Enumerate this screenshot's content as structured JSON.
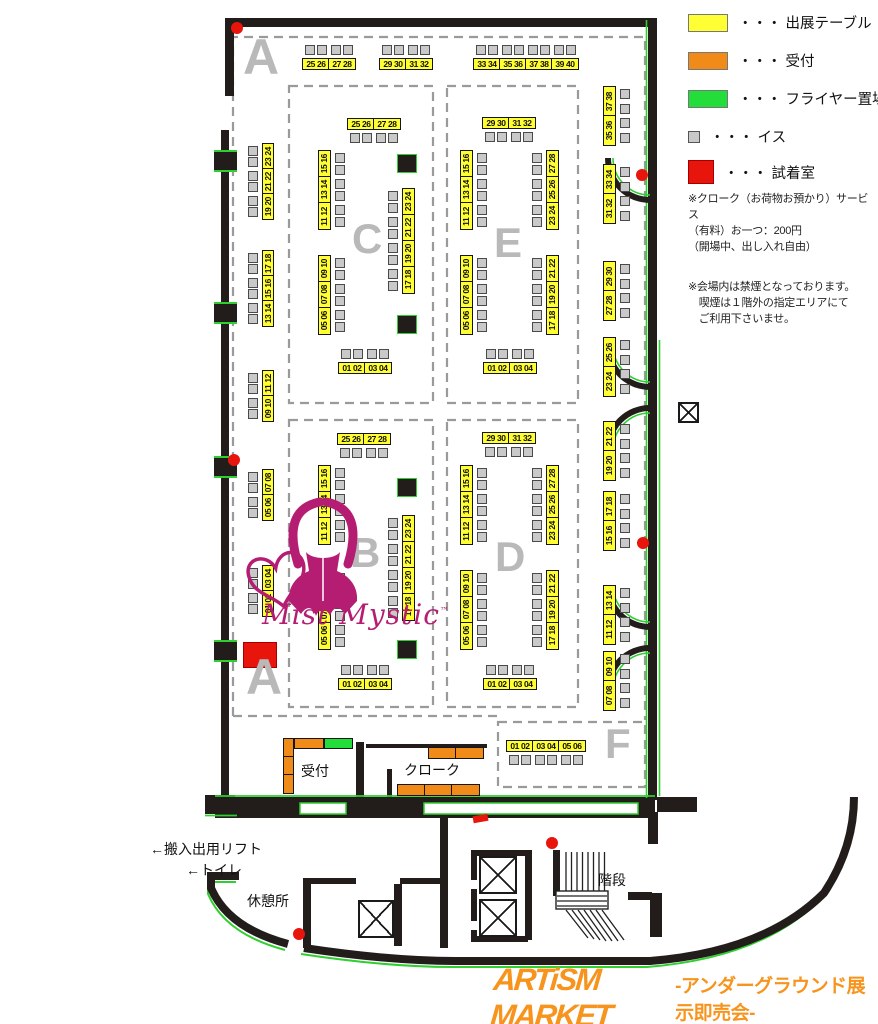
{
  "legend": {
    "items": [
      {
        "key": "exhibit-table",
        "color": "#ffff33",
        "label": "・・・ 出展テーブル"
      },
      {
        "key": "reception",
        "color": "#f08a19",
        "label": "・・・ 受付"
      },
      {
        "key": "flyer-area",
        "color": "#22dd3a",
        "label": "・・・ フライヤー置場"
      },
      {
        "key": "chair",
        "color": "#c9c9c9",
        "label": "・・・ イス"
      },
      {
        "key": "fitting-room",
        "color": "#e8150d",
        "label": "・・・ 試着室"
      }
    ]
  },
  "notes": [
    "※クローク（お荷物お預かり）サービス\n（有料）お一つ：200円\n（開場中、出し入れ自由）",
    "※会場内は禁煙となっております。\n　喫煙は１階外の指定エリアにて\n　ご利用下さいませ。"
  ],
  "labels": {
    "reception": "受付",
    "cloak": "クローク",
    "stairs": "階段",
    "rest_area": "休憩所",
    "toilet": "←トイレ",
    "lift": "←搬入出用リフト"
  },
  "logo": {
    "brand": "ARTiSM MARKET",
    "tagline": "-アンダーグラウンド展示即売会-",
    "mist": "Mist Mystic",
    "tm": "™"
  },
  "colors": {
    "table": "#ffff33",
    "reception": "#f08a19",
    "flyer": "#22dd3a",
    "chair": "#c9c9c9",
    "fitting": "#e8150d",
    "wall": "#221d1a",
    "accent_green": "#2fcf2f",
    "letter": "#b9b9b9",
    "brand": "#f7941d",
    "mist": "#b51d73"
  },
  "sections": [
    {
      "label": "A",
      "x": 243,
      "y": 36,
      "size": 50
    },
    {
      "label": "C",
      "x": 352,
      "y": 221,
      "size": 42
    },
    {
      "label": "E",
      "x": 494,
      "y": 225,
      "size": 42
    },
    {
      "label": "B",
      "x": 350,
      "y": 535,
      "size": 42
    },
    {
      "label": "D",
      "x": 495,
      "y": 539,
      "size": 42
    },
    {
      "label": "A",
      "x": 246,
      "y": 656,
      "size": 50
    },
    {
      "label": "F",
      "x": 605,
      "y": 726,
      "size": 42
    }
  ],
  "plan": {
    "table_groups": [
      {
        "sec": "A",
        "o": "h",
        "x": 302,
        "y": 58,
        "sw": 28,
        "sh": 12,
        "labels": [
          "25 26",
          "27 28"
        ],
        "chairs": "top"
      },
      {
        "sec": "A",
        "o": "h",
        "x": 379,
        "y": 58,
        "sw": 28,
        "sh": 12,
        "labels": [
          "29 30",
          "31 32"
        ],
        "chairs": "top"
      },
      {
        "sec": "A",
        "o": "h",
        "x": 473,
        "y": 58,
        "sw": 28,
        "sh": 12,
        "labels": [
          "33 34",
          "35 36",
          "37 38",
          "39 40"
        ],
        "chairs": "top"
      },
      {
        "sec": "A",
        "o": "v",
        "x": 262,
        "y": 143,
        "sw": 12,
        "sh": 27,
        "labels": [
          "23 24",
          "21 22",
          "19 20"
        ],
        "chairs": "left"
      },
      {
        "sec": "A",
        "o": "v",
        "x": 262,
        "y": 250,
        "sw": 12,
        "sh": 27,
        "labels": [
          "17 18",
          "15 16",
          "13 14"
        ],
        "chairs": "left"
      },
      {
        "sec": "A",
        "o": "v",
        "x": 262,
        "y": 370,
        "sw": 12,
        "sh": 27,
        "labels": [
          "11 12",
          "09 10"
        ],
        "chairs": "left"
      },
      {
        "sec": "A",
        "o": "v",
        "x": 262,
        "y": 469,
        "sw": 12,
        "sh": 27,
        "labels": [
          "07 08",
          "05 06"
        ],
        "chairs": "left"
      },
      {
        "sec": "A",
        "o": "v",
        "x": 262,
        "y": 565,
        "sw": 12,
        "sh": 27,
        "labels": [
          "03 04",
          "01 02"
        ],
        "chairs": "left"
      },
      {
        "sec": "C",
        "o": "h",
        "x": 347,
        "y": 118,
        "sw": 28,
        "sh": 12,
        "labels": [
          "25 26",
          "27 28"
        ],
        "chairs": "bottom"
      },
      {
        "sec": "C",
        "o": "v",
        "x": 318,
        "y": 150,
        "sw": 13,
        "sh": 28,
        "labels": [
          "15 16",
          "13 14",
          "11 12"
        ],
        "chairs": "right"
      },
      {
        "sec": "C",
        "o": "v",
        "x": 318,
        "y": 255,
        "sw": 13,
        "sh": 28,
        "labels": [
          "09 10",
          "07 08",
          "05 06"
        ],
        "chairs": "right"
      },
      {
        "sec": "C",
        "o": "v",
        "x": 402,
        "y": 188,
        "sw": 13,
        "sh": 28,
        "labels": [
          "23 24",
          "21 22",
          "19 20",
          "17 18"
        ],
        "chairs": "left"
      },
      {
        "sec": "C",
        "o": "h",
        "x": 338,
        "y": 362,
        "sw": 28,
        "sh": 12,
        "labels": [
          "01 02",
          "03 04"
        ],
        "chairs": "top"
      },
      {
        "sec": "E",
        "o": "h",
        "x": 482,
        "y": 117,
        "sw": 28,
        "sh": 12,
        "labels": [
          "29 30",
          "31 32"
        ],
        "chairs": "bottom"
      },
      {
        "sec": "E",
        "o": "v",
        "x": 460,
        "y": 150,
        "sw": 13,
        "sh": 28,
        "labels": [
          "15 16",
          "13 14",
          "11 12"
        ],
        "chairs": "right"
      },
      {
        "sec": "E",
        "o": "v",
        "x": 460,
        "y": 255,
        "sw": 13,
        "sh": 28,
        "labels": [
          "09 10",
          "07 08",
          "05 06"
        ],
        "chairs": "right"
      },
      {
        "sec": "E",
        "o": "v",
        "x": 546,
        "y": 150,
        "sw": 13,
        "sh": 28,
        "labels": [
          "27 28",
          "25 26",
          "23 24"
        ],
        "chairs": "left"
      },
      {
        "sec": "E",
        "o": "v",
        "x": 546,
        "y": 255,
        "sw": 13,
        "sh": 28,
        "labels": [
          "21 22",
          "19 20",
          "17 18"
        ],
        "chairs": "left"
      },
      {
        "sec": "E",
        "o": "h",
        "x": 483,
        "y": 362,
        "sw": 28,
        "sh": 12,
        "labels": [
          "01 02",
          "03 04"
        ],
        "chairs": "top"
      },
      {
        "sec": "B",
        "o": "h",
        "x": 337,
        "y": 433,
        "sw": 28,
        "sh": 12,
        "labels": [
          "25 26",
          "27 28"
        ],
        "chairs": "bottom"
      },
      {
        "sec": "B",
        "o": "v",
        "x": 318,
        "y": 465,
        "sw": 13,
        "sh": 28,
        "labels": [
          "15 16",
          "13 14",
          "11 12"
        ],
        "chairs": "right"
      },
      {
        "sec": "B",
        "o": "v",
        "x": 318,
        "y": 570,
        "sw": 13,
        "sh": 28,
        "labels": [
          "09 10",
          "07 08",
          "05 06"
        ],
        "chairs": "right"
      },
      {
        "sec": "B",
        "o": "v",
        "x": 402,
        "y": 515,
        "sw": 13,
        "sh": 28,
        "labels": [
          "23 24",
          "21 22",
          "19 20",
          "17 18"
        ],
        "chairs": "left"
      },
      {
        "sec": "B",
        "o": "h",
        "x": 338,
        "y": 678,
        "sw": 28,
        "sh": 12,
        "labels": [
          "01 02",
          "03 04"
        ],
        "chairs": "top"
      },
      {
        "sec": "D",
        "o": "h",
        "x": 482,
        "y": 432,
        "sw": 28,
        "sh": 12,
        "labels": [
          "29 30",
          "31 32"
        ],
        "chairs": "bottom"
      },
      {
        "sec": "D",
        "o": "v",
        "x": 460,
        "y": 465,
        "sw": 13,
        "sh": 28,
        "labels": [
          "15 16",
          "13 14",
          "11 12"
        ],
        "chairs": "right"
      },
      {
        "sec": "D",
        "o": "v",
        "x": 460,
        "y": 570,
        "sw": 13,
        "sh": 28,
        "labels": [
          "09 10",
          "07 08",
          "05 06"
        ],
        "chairs": "right"
      },
      {
        "sec": "D",
        "o": "v",
        "x": 546,
        "y": 465,
        "sw": 13,
        "sh": 28,
        "labels": [
          "27 28",
          "25 26",
          "23 24"
        ],
        "chairs": "left"
      },
      {
        "sec": "D",
        "o": "v",
        "x": 546,
        "y": 570,
        "sw": 13,
        "sh": 28,
        "labels": [
          "21 22",
          "19 20",
          "17 18"
        ],
        "chairs": "left"
      },
      {
        "sec": "D",
        "o": "h",
        "x": 483,
        "y": 678,
        "sw": 28,
        "sh": 12,
        "labels": [
          "01 02",
          "03 04"
        ],
        "chairs": "top"
      },
      {
        "sec": "F",
        "o": "v",
        "x": 603,
        "y": 86,
        "sw": 13,
        "sh": 31,
        "labels": [
          "37 38",
          "35 36"
        ],
        "chairs": "right"
      },
      {
        "sec": "F",
        "o": "v",
        "x": 603,
        "y": 164,
        "sw": 13,
        "sh": 31,
        "labels": [
          "33 34",
          "31 32"
        ],
        "chairs": "right"
      },
      {
        "sec": "F",
        "o": "v",
        "x": 603,
        "y": 261,
        "sw": 13,
        "sh": 31,
        "labels": [
          "29 30",
          "27 28"
        ],
        "chairs": "right"
      },
      {
        "sec": "F",
        "o": "v",
        "x": 603,
        "y": 337,
        "sw": 13,
        "sh": 31,
        "labels": [
          "25 26",
          "23 24"
        ],
        "chairs": "right"
      },
      {
        "sec": "F",
        "o": "v",
        "x": 603,
        "y": 421,
        "sw": 13,
        "sh": 31,
        "labels": [
          "21 22",
          "19 20"
        ],
        "chairs": "right"
      },
      {
        "sec": "F",
        "o": "v",
        "x": 603,
        "y": 491,
        "sw": 13,
        "sh": 31,
        "labels": [
          "17 18",
          "15 16"
        ],
        "chairs": "right"
      },
      {
        "sec": "F",
        "o": "v",
        "x": 603,
        "y": 585,
        "sw": 13,
        "sh": 31,
        "labels": [
          "13 14",
          "11 12"
        ],
        "chairs": "right"
      },
      {
        "sec": "F",
        "o": "v",
        "x": 603,
        "y": 651,
        "sw": 13,
        "sh": 31,
        "labels": [
          "09 10",
          "07 08"
        ],
        "chairs": "right"
      },
      {
        "sec": "F",
        "o": "h",
        "x": 506,
        "y": 740,
        "sw": 28,
        "sh": 12,
        "labels": [
          "01 02",
          "03 04",
          "05 06"
        ],
        "chairs": "bottom"
      },
      {
        "sec": "reception",
        "o": "v",
        "x": 283,
        "y": 738,
        "sw": 11,
        "sh": 20,
        "labels": [
          "",
          "",
          ""
        ],
        "chairs": "none",
        "color": "reception"
      },
      {
        "sec": "reception",
        "o": "h",
        "x": 294,
        "y": 738,
        "sw": 30,
        "sh": 11,
        "labels": [
          ""
        ],
        "chairs": "none",
        "color": "reception"
      },
      {
        "sec": "flyer",
        "o": "h",
        "x": 324,
        "y": 738,
        "sw": 29,
        "sh": 11,
        "labels": [
          ""
        ],
        "chairs": "none",
        "color": "flyer"
      },
      {
        "sec": "cloak",
        "o": "h",
        "x": 428,
        "y": 747,
        "sw": 29,
        "sh": 12,
        "labels": [
          "",
          ""
        ],
        "chairs": "none",
        "color": "reception"
      },
      {
        "sec": "cloak",
        "o": "h",
        "x": 397,
        "y": 784,
        "sw": 29,
        "sh": 12,
        "labels": [
          "",
          "",
          ""
        ],
        "chairs": "none",
        "color": "reception"
      }
    ],
    "pillars": [
      [
        397,
        154
      ],
      [
        397,
        315
      ],
      [
        397,
        478
      ],
      [
        397,
        640
      ]
    ],
    "wall_pillars": [
      [
        214,
        150
      ],
      [
        214,
        302
      ],
      [
        214,
        456
      ],
      [
        214,
        640
      ]
    ],
    "red_dots": [
      [
        237,
        28
      ],
      [
        642,
        175
      ],
      [
        234,
        460
      ],
      [
        643,
        543
      ],
      [
        552,
        843
      ],
      [
        299,
        934
      ]
    ],
    "red_marker": {
      "x": 473,
      "y": 815,
      "w": 15,
      "h": 7
    },
    "fitting_room": {
      "x": 243,
      "y": 642,
      "w": 34,
      "h": 26
    },
    "elevators": [
      {
        "x": 358,
        "y": 900,
        "w": 36,
        "h": 38
      },
      {
        "x": 479,
        "y": 856,
        "w": 38,
        "h": 38
      },
      {
        "x": 479,
        "y": 899,
        "w": 38,
        "h": 38
      }
    ],
    "crossbox": {
      "x": 678,
      "y": 402,
      "s": 21
    }
  }
}
